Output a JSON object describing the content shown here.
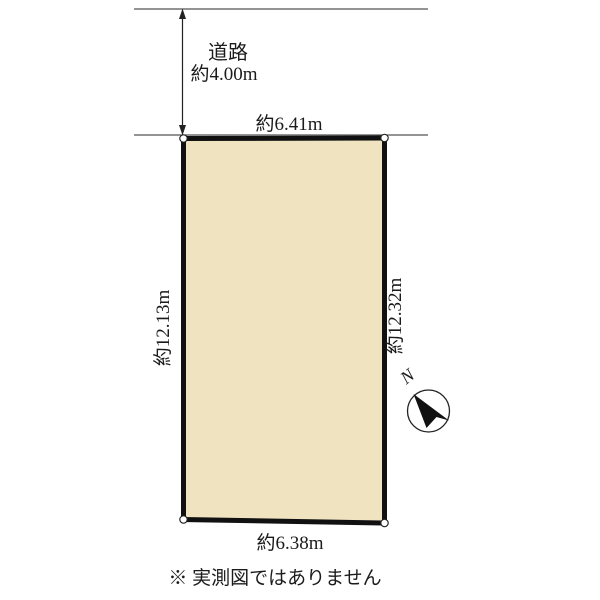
{
  "diagram": {
    "road": {
      "name": "道路",
      "width_label": "約4.00m"
    },
    "plot": {
      "fill_color": "#f0e3c0",
      "border_color": "#111111",
      "top_dim": "約6.41m",
      "bottom_dim": "約6.38m",
      "left_dim": "約12.13m",
      "right_dim": "約12.32m"
    },
    "compass": {
      "north_label": "N"
    },
    "disclaimer": "※ 実測図ではありません"
  }
}
